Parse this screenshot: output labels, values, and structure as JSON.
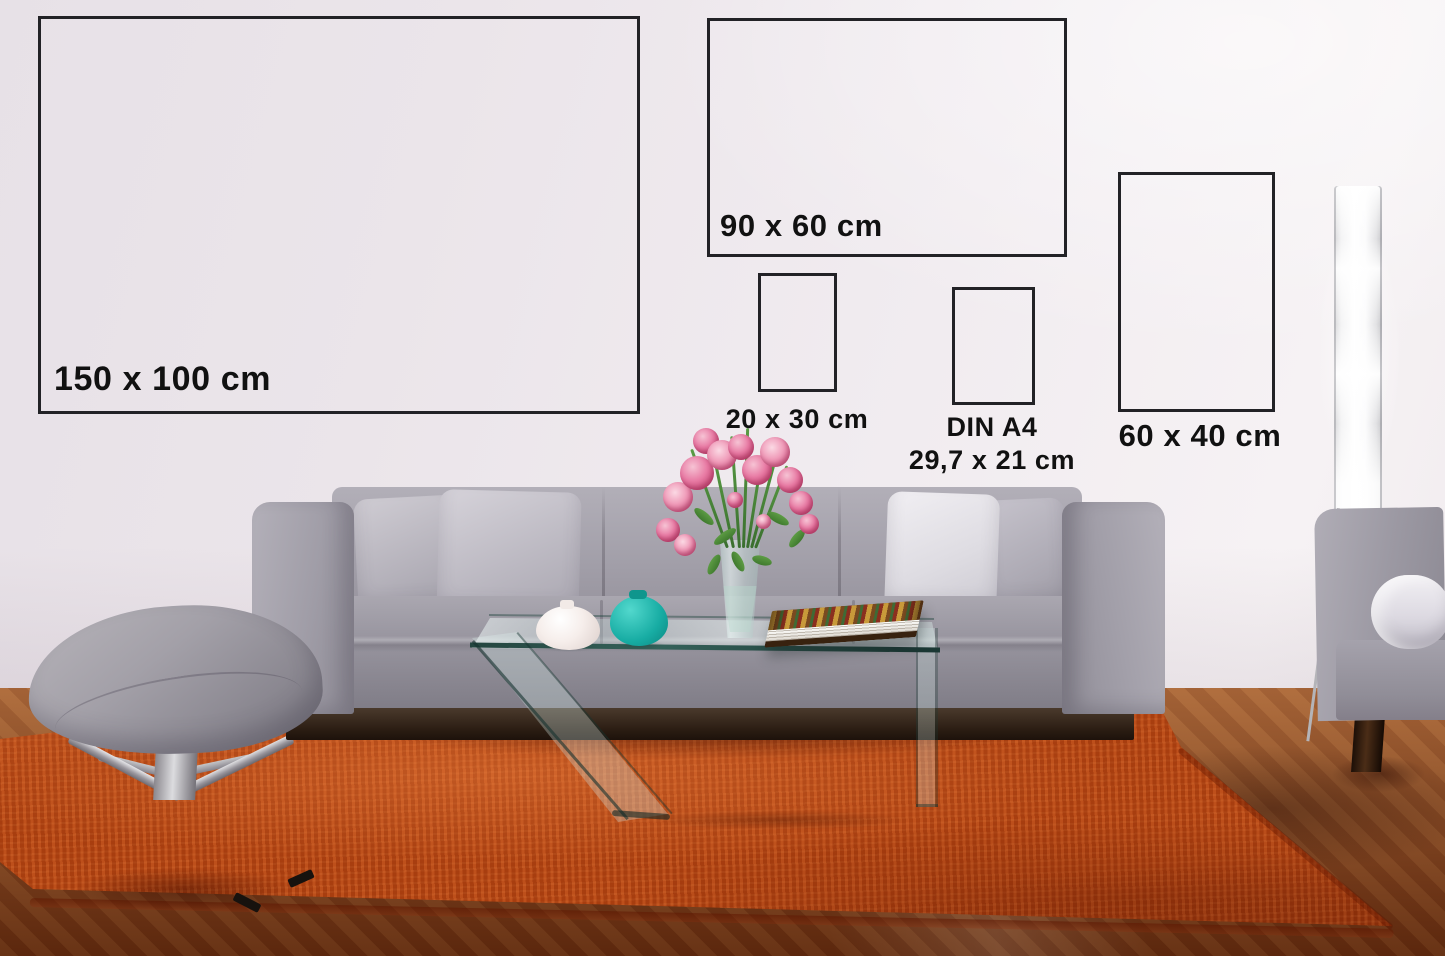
{
  "size_guide": {
    "frames": [
      {
        "id": "poster-150x100",
        "label": "150 x 100 cm"
      },
      {
        "id": "poster-90x60",
        "label": "90 x 60 cm"
      },
      {
        "id": "poster-20x30",
        "label": "20 x 30 cm"
      },
      {
        "id": "poster-din-a4",
        "label_lines": [
          "DIN A4",
          "29,7 x 21 cm"
        ]
      },
      {
        "id": "poster-60x40",
        "label": "60 x 40 cm"
      }
    ]
  },
  "palette": {
    "frame_border": "#222226",
    "label_text": "#111111",
    "wall": "#ece6ec",
    "rug_orange": "#b04312",
    "wood_floor": "#7c3a16",
    "sofa_gray": "#9d9aa4",
    "pillow_light": "#d5d2d9",
    "teal_vase": "#17aca3",
    "flower_pink": "#e87ba4",
    "lamp_white": "#ffffff"
  }
}
